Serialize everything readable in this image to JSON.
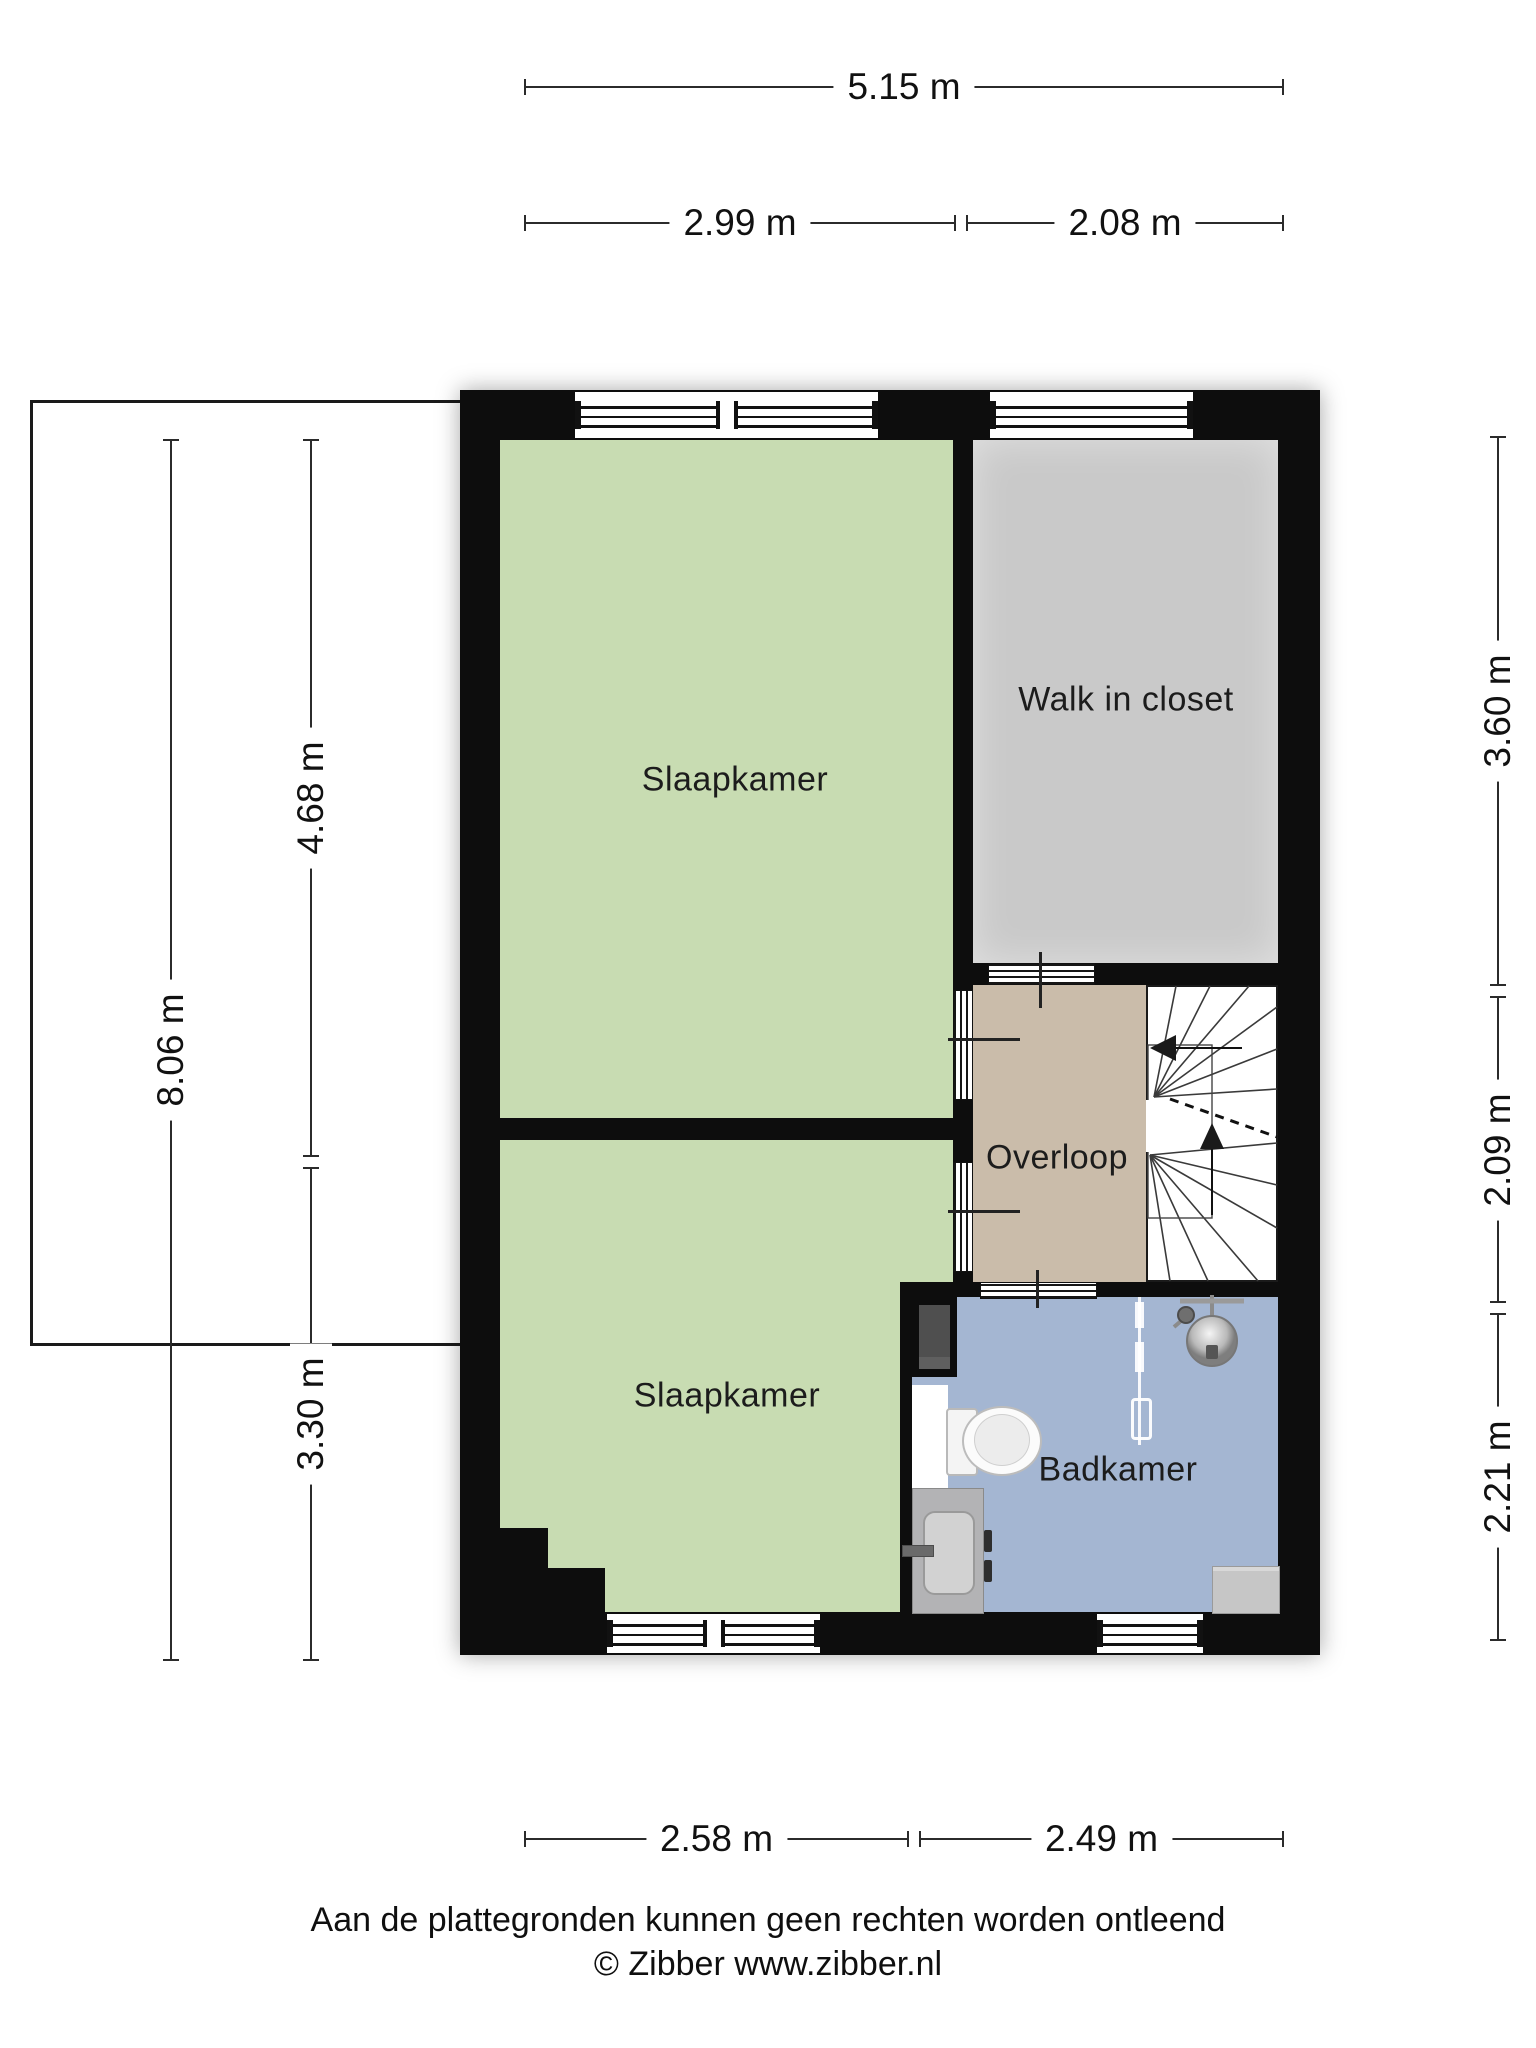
{
  "title": "Floor plan - first floor (Zibber)",
  "rooms": [
    {
      "id": "slaapkamer-top",
      "label": "Slaapkamer",
      "color": "#c8dcb2"
    },
    {
      "id": "walk-in-closet",
      "label": "Walk in closet",
      "color": "#c9c9c9"
    },
    {
      "id": "overloop",
      "label": "Overloop",
      "color": "#cabcaa"
    },
    {
      "id": "slaapkamer-bottom",
      "label": "Slaapkamer",
      "color": "#c8dcb2"
    },
    {
      "id": "badkamer",
      "label": "Badkamer",
      "color": "#a4b6d2"
    }
  ],
  "dimensions": {
    "top_total": "5.15 m",
    "top_left": "2.99 m",
    "top_right": "2.08 m",
    "left_total": "8.06 m",
    "left_upper": "4.68 m",
    "left_lower": "3.30 m",
    "right_upper": "3.60 m",
    "right_middle": "2.09 m",
    "right_lower": "2.21 m",
    "bottom_left": "2.58 m",
    "bottom_right": "2.49 m"
  },
  "fixtures": [
    "stairs",
    "stair-up-arrow",
    "stair-exit-arrow",
    "toilet",
    "washbasin",
    "faucet",
    "shower-head",
    "shower-glass-screen",
    "radiator",
    "shaft"
  ],
  "colors": {
    "wall": "#0d0d0d",
    "bedroom_green": "#c8dcb2",
    "closet_gray": "#c9c9c9",
    "landing_tan": "#cabcaa",
    "bathroom_blue": "#a4b6d2",
    "dimension_line": "#2b2b2b",
    "background": "#ffffff"
  },
  "footer": {
    "line1": "Aan de plattegronden kunnen geen rechten worden ontleend",
    "line2": "© Zibber www.zibber.nl"
  }
}
